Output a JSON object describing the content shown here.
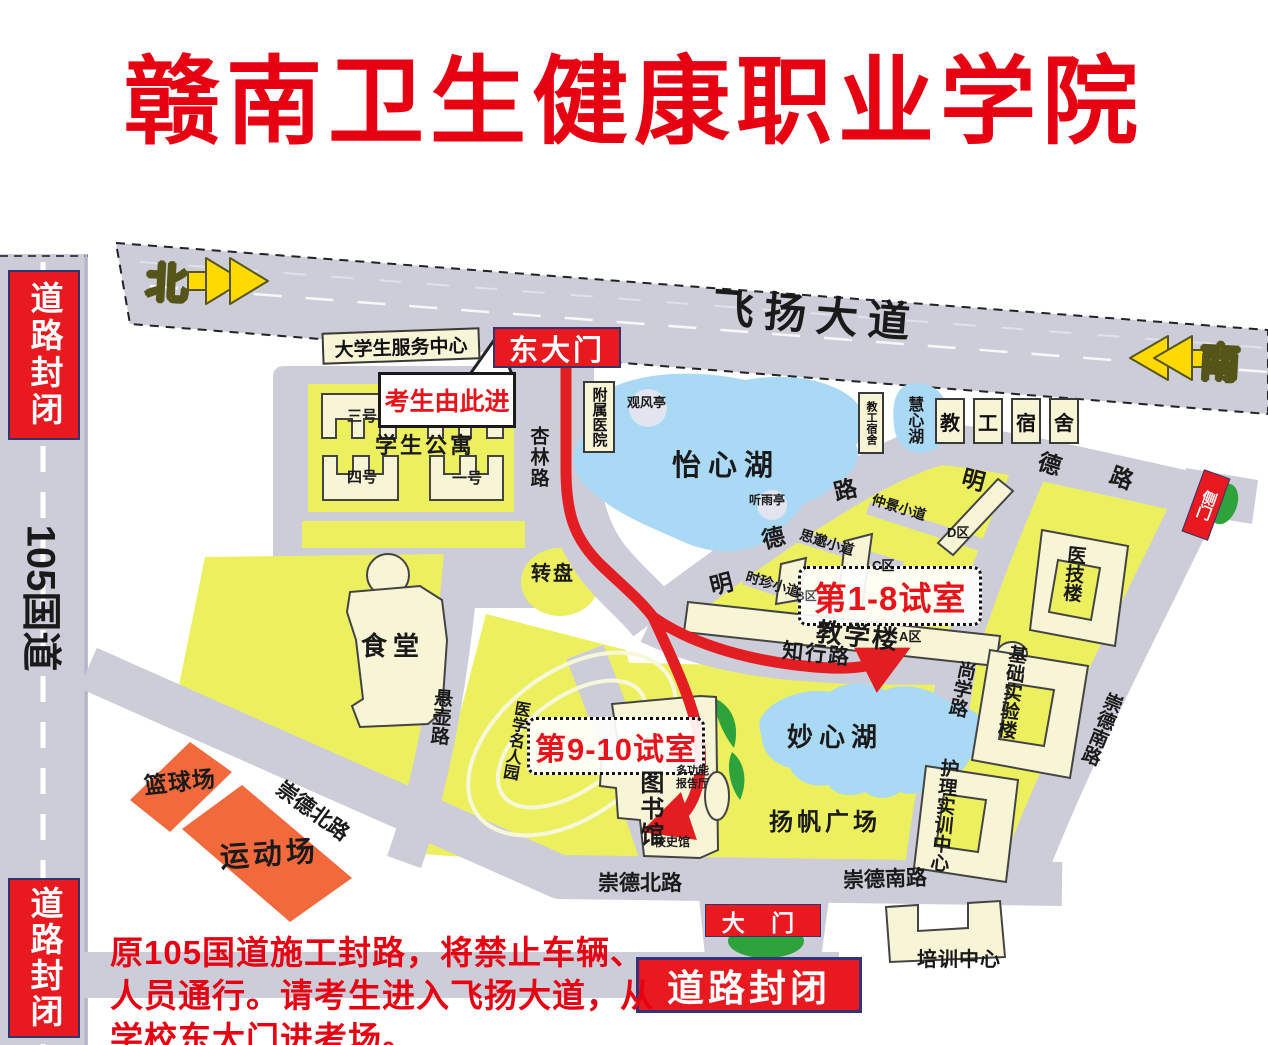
{
  "title": "赣南卫生健康职业学院",
  "colors": {
    "sign_red": "#e8191f",
    "title_red": "#e60012",
    "campus_yellow": "#edf05e",
    "road_gray": "#cdcdd9",
    "lake_blue": "#a9d9f5",
    "building_cream": "#f8f4d6",
    "sports_orange": "#f2693c",
    "lawn_green": "#2ea33c",
    "arrow_yellow": "#ffd900"
  },
  "compass": {
    "north": "北",
    "south": "南"
  },
  "roads": {
    "feiyang": "飞扬大道",
    "g105": "105国道",
    "xinglin": "杏林路",
    "zhixing": "知行路",
    "shangxue": "尚学路",
    "xuanhu": "悬壶路",
    "mingde_upper": [
      "明",
      "德",
      "路"
    ],
    "mingde_lower": [
      "明",
      "德",
      "路"
    ],
    "chongde_north_diagonal": "崇德北路",
    "chongde_north_bottom": "崇德北路",
    "chongde_south_bottom": "崇德南路",
    "chongde_south_right": "崇德南路"
  },
  "trails": {
    "zhongjing": "仲景小道",
    "simiao": "思邈小道",
    "shizhen": "时珍小道"
  },
  "gates": {
    "east": "东大门",
    "main": "大 门",
    "side": "侧门"
  },
  "signs": {
    "road_closed_top": "道路封闭",
    "road_closed_bottom": "道路封闭",
    "road_closed_center": "道路封闭",
    "entry_callout": "考生由此进"
  },
  "exam_rooms": {
    "rooms_1_8": "第1-8试室",
    "rooms_9_10": "第9-10试室"
  },
  "lakes": {
    "yixin": "怡心湖",
    "miaoxin": "妙心湖",
    "huixin": "慧心湖"
  },
  "pavilions": {
    "guanfeng": "观风亭",
    "tingyu": "听雨亭"
  },
  "places": {
    "service_center": "大学生服务中心",
    "hospital": "附属医院",
    "apartments": "学生公寓",
    "bldg_no3": "三号",
    "bldg_no4": "四号",
    "bldg_no1": "一号",
    "canteen": "食堂",
    "roundabout": "转盘",
    "teaching": "教学楼",
    "zone_a": "A区",
    "zone_b": "B区",
    "zone_c": "C区",
    "zone_d": "D区",
    "staff_dorm": "教工宿舍",
    "staff_dorm_chars": [
      "教",
      "工",
      "宿",
      "舍"
    ],
    "library": "图书馆",
    "hall_line1": "多功能",
    "hall_line2": "报告厅",
    "history_hall": "校史馆",
    "yangfan_square": "扬帆广场",
    "celebrity_garden": "医学名人园",
    "medical_tech": "医技楼",
    "basic_lab": "基础实验楼",
    "nursing_center": "护理实训中心",
    "training_center": "培训中心",
    "basketball": "篮球场",
    "sports_field": "运动场"
  },
  "notice": {
    "line1": "原105国道施工封路，将禁止车辆、",
    "line2": "人员通行。请考生进入飞扬大道，从",
    "line3": "学校东大门进考场。"
  }
}
